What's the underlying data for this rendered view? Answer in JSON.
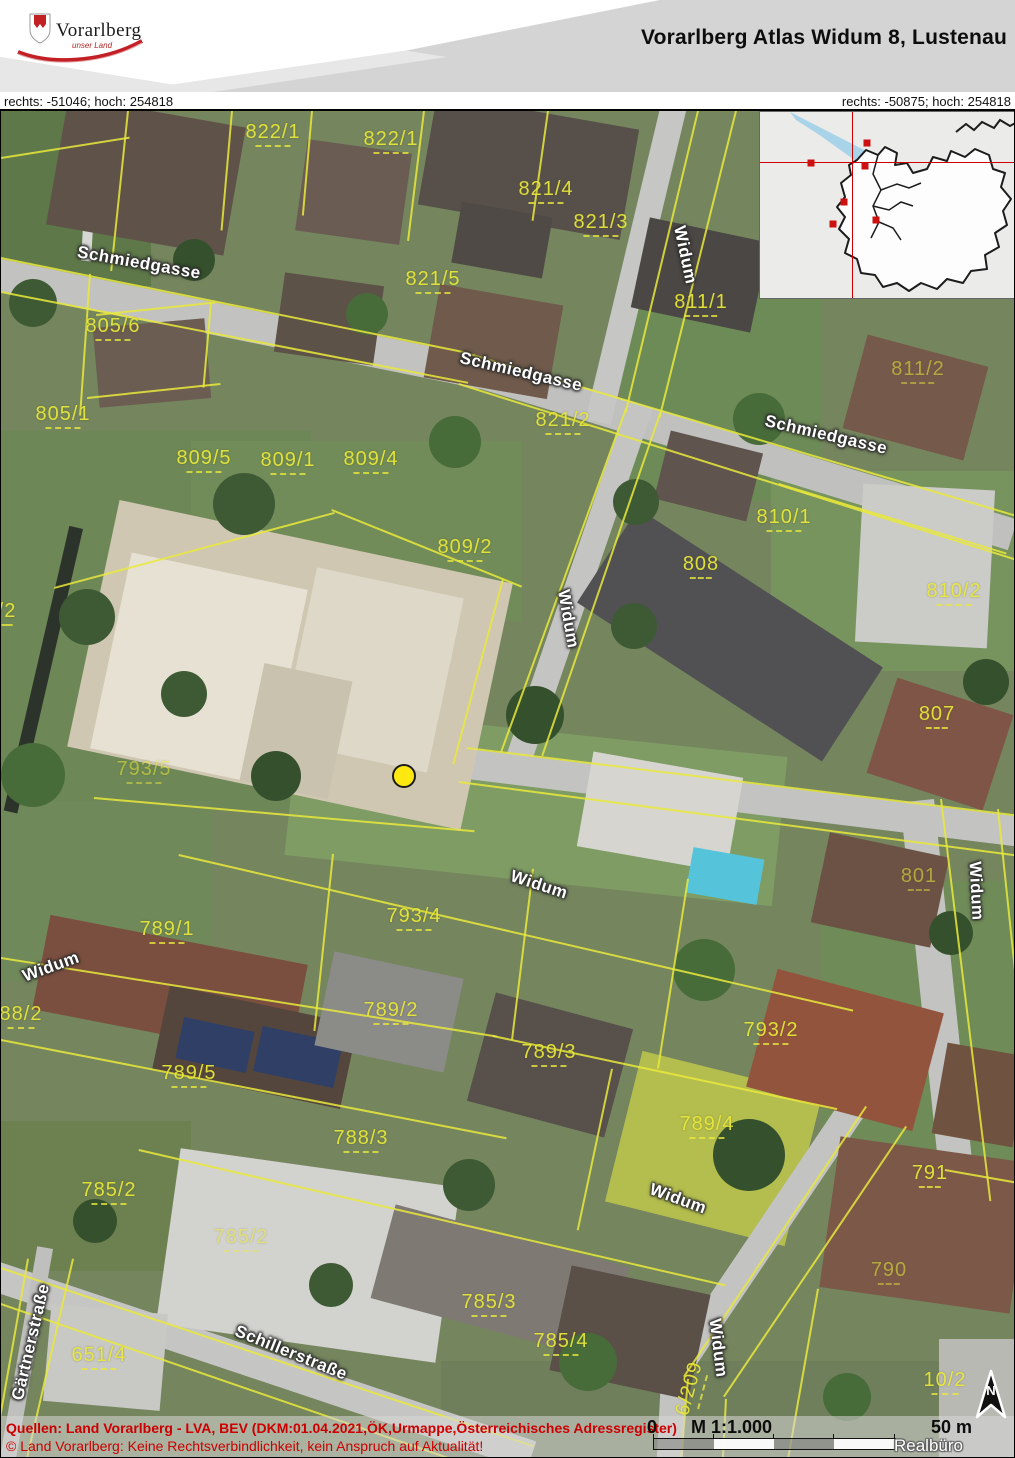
{
  "header": {
    "logo": {
      "brand": "Vorarlberg",
      "tagline": "unser Land"
    },
    "title": "Vorarlberg Atlas Widum 8, Lustenau"
  },
  "coordinates": {
    "left": "rechts: -51046; hoch: 254818",
    "right": "rechts: -50875; hoch: 254818"
  },
  "map": {
    "colors": {
      "cadastral_yellow": "#e9e93c",
      "marker_yellow": "#ffe810",
      "footer_red": "#cc0000",
      "crosshair_red": "#cc0000",
      "lake_blue": "#a9d3e8"
    },
    "marker": {
      "name": "address-marker",
      "x": 403,
      "y": 665
    },
    "street_labels": [
      {
        "text": "Schmiedgasse",
        "x": 138,
        "y": 152,
        "rot": 10
      },
      {
        "text": "Schmiedgasse",
        "x": 520,
        "y": 261,
        "rot": 13
      },
      {
        "text": "Schmiedgasse",
        "x": 825,
        "y": 324,
        "rot": 13
      },
      {
        "text": "Widum",
        "x": 684,
        "y": 144,
        "rot": 78
      },
      {
        "text": "Widum",
        "x": 567,
        "y": 508,
        "rot": 80
      },
      {
        "text": "Widum",
        "x": 50,
        "y": 856,
        "rot": -20
      },
      {
        "text": "Widum",
        "x": 538,
        "y": 774,
        "rot": 18
      },
      {
        "text": "Widum",
        "x": 975,
        "y": 780,
        "rot": 87
      },
      {
        "text": "Widum",
        "x": 677,
        "y": 1088,
        "rot": 20
      },
      {
        "text": "Widum",
        "x": 717,
        "y": 1237,
        "rot": 83
      },
      {
        "text": "Schillerstraße",
        "x": 290,
        "y": 1242,
        "rot": 22
      },
      {
        "text": "Gärtnerstraße",
        "x": 30,
        "y": 1231,
        "rot": -77
      }
    ],
    "parcel_labels": [
      {
        "text": "822/1",
        "x": 272,
        "y": 23
      },
      {
        "text": "822/1",
        "x": 390,
        "y": 30
      },
      {
        "text": "821/4",
        "x": 545,
        "y": 80
      },
      {
        "text": "821/3",
        "x": 600,
        "y": 113
      },
      {
        "text": "821/5",
        "x": 432,
        "y": 170
      },
      {
        "text": "811/1",
        "x": 700,
        "y": 193
      },
      {
        "text": "805/6",
        "x": 112,
        "y": 217
      },
      {
        "text": "805/1",
        "x": 62,
        "y": 305
      },
      {
        "text": "821/2",
        "x": 562,
        "y": 311
      },
      {
        "text": "811/2",
        "x": 917,
        "y": 260,
        "faint": true
      },
      {
        "text": "809/5",
        "x": 203,
        "y": 349
      },
      {
        "text": "809/1",
        "x": 287,
        "y": 351
      },
      {
        "text": "809/4",
        "x": 370,
        "y": 350
      },
      {
        "text": "810/1",
        "x": 783,
        "y": 408
      },
      {
        "text": "809/2",
        "x": 464,
        "y": 438
      },
      {
        "text": "808",
        "x": 700,
        "y": 455
      },
      {
        "text": "810/2",
        "x": 953,
        "y": 482
      },
      {
        "text": "807",
        "x": 936,
        "y": 605
      },
      {
        "text": "793/5",
        "x": 143,
        "y": 660,
        "faint": true
      },
      {
        "text": "801",
        "x": 918,
        "y": 767,
        "faint": true
      },
      {
        "text": "793/4",
        "x": 413,
        "y": 807
      },
      {
        "text": "789/1",
        "x": 166,
        "y": 820
      },
      {
        "text": "88/2",
        "x": 20,
        "y": 905
      },
      {
        "text": "789/2",
        "x": 390,
        "y": 901
      },
      {
        "text": "793/2",
        "x": 770,
        "y": 921
      },
      {
        "text": "789/3",
        "x": 548,
        "y": 943
      },
      {
        "text": "789/5",
        "x": 188,
        "y": 964
      },
      {
        "text": "789/4",
        "x": 706,
        "y": 1015
      },
      {
        "text": "788/3",
        "x": 360,
        "y": 1029
      },
      {
        "text": "791",
        "x": 929,
        "y": 1064
      },
      {
        "text": "785/2",
        "x": 108,
        "y": 1081
      },
      {
        "text": "785/2",
        "x": 240,
        "y": 1128,
        "faint": true
      },
      {
        "text": "790",
        "x": 888,
        "y": 1161,
        "faint": true
      },
      {
        "text": "785/3",
        "x": 488,
        "y": 1193
      },
      {
        "text": "785/4",
        "x": 560,
        "y": 1232
      },
      {
        "text": "651/4",
        "x": 98,
        "y": 1246
      },
      {
        "text": "10/2",
        "x": 944,
        "y": 1271
      },
      {
        "text": "/2",
        "x": 6,
        "y": 502
      },
      {
        "text": "6/209",
        "x": 690,
        "y": 1278,
        "rot": -75
      }
    ]
  },
  "inset": {
    "crosshair": {
      "x": 92,
      "y": 50
    },
    "squares": [
      {
        "x": 107,
        "y": 31
      },
      {
        "x": 51,
        "y": 51
      },
      {
        "x": 105,
        "y": 54
      },
      {
        "x": 84,
        "y": 90
      },
      {
        "x": 73,
        "y": 112
      },
      {
        "x": 116,
        "y": 108
      }
    ]
  },
  "footer": {
    "source_line": "Quellen: Land Vorarlberg - LVA, BEV (DKM:01.04.2021,ÖK,Urmappe,Österreichisches Adressregister)",
    "disclaimer_line": "© Land Vorarlberg: Keine Rechtsverbindlichkeit, kein Anspruch auf Aktualität!",
    "scale": {
      "zero": "0",
      "ratio": "M 1:1.000",
      "distance": "50 m",
      "credit": "Realbüro Hagen"
    },
    "north_label": "N"
  }
}
